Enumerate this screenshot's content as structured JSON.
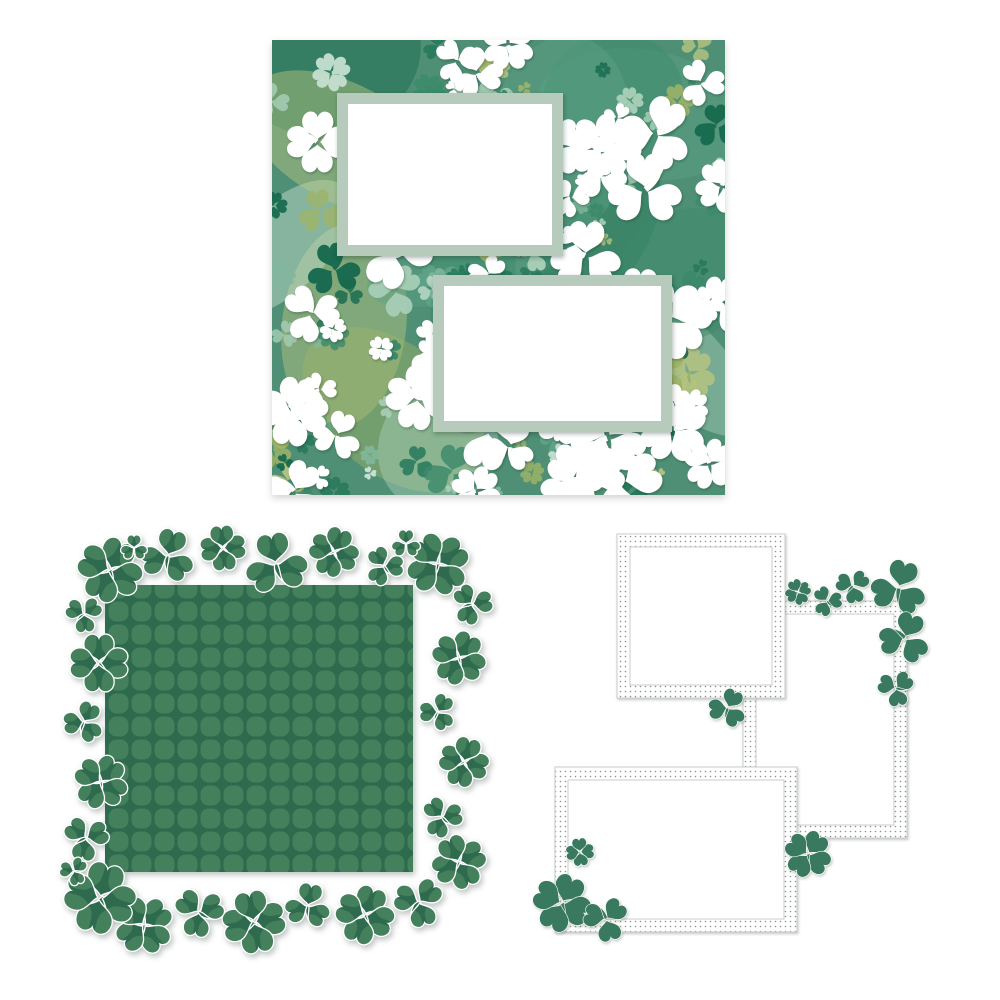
{
  "canvas": {
    "background": "#ffffff",
    "width": 1000,
    "height": 1000,
    "description": "Three St. Patrick's Day shamrock scrapbook die-cut pages on white"
  },
  "clover_page": {
    "x": 272,
    "y": 40,
    "w": 453,
    "h": 455,
    "seed": 1317,
    "base": "#4f8f75",
    "palette": [
      "#176a4e",
      "#27795c",
      "#3b8a6b",
      "#5ea287",
      "#82b89d",
      "#a8cfb8",
      "#c9e2d3",
      "#9fb468",
      "#bcc781"
    ],
    "white": "#ffffff",
    "blotch_count": 14,
    "green_count": 120,
    "white_count": 72,
    "mat_color": "#b6cbbc",
    "mat_inner": "#ffffff",
    "mats": [
      {
        "x": 65,
        "y": 53,
        "w": 226,
        "h": 163,
        "border": 11
      },
      {
        "x": 161,
        "y": 235,
        "w": 239,
        "h": 157,
        "border": 11
      }
    ]
  },
  "diecut_page": {
    "x": 38,
    "y": 508,
    "w": 450,
    "h": 450,
    "base": "#2d6a4e",
    "tile": "#44805b",
    "cut": "#ffffff",
    "square": {
      "x": 67,
      "y": 77,
      "w": 308,
      "h": 287
    },
    "clovers": [
      {
        "x": 72,
        "y": 62,
        "r": 30,
        "t": 4,
        "rot": -20
      },
      {
        "x": 130,
        "y": 48,
        "r": 25,
        "t": 3,
        "rot": 15
      },
      {
        "x": 185,
        "y": 40,
        "r": 21,
        "t": 4,
        "rot": 40
      },
      {
        "x": 238,
        "y": 56,
        "r": 29,
        "t": 3,
        "rot": -10
      },
      {
        "x": 296,
        "y": 44,
        "r": 23,
        "t": 4,
        "rot": 65
      },
      {
        "x": 346,
        "y": 58,
        "r": 18,
        "t": 3,
        "rot": -30
      },
      {
        "x": 400,
        "y": 56,
        "r": 29,
        "t": 4,
        "rot": 10
      },
      {
        "x": 434,
        "y": 96,
        "r": 19,
        "t": 3,
        "rot": 80
      },
      {
        "x": 421,
        "y": 150,
        "r": 25,
        "t": 4,
        "rot": -15
      },
      {
        "x": 400,
        "y": 204,
        "r": 17,
        "t": 3,
        "rot": 30
      },
      {
        "x": 426,
        "y": 254,
        "r": 23,
        "t": 4,
        "rot": 60
      },
      {
        "x": 404,
        "y": 309,
        "r": 19,
        "t": 3,
        "rot": -40
      },
      {
        "x": 421,
        "y": 354,
        "r": 25,
        "t": 4,
        "rot": 20
      },
      {
        "x": 381,
        "y": 394,
        "r": 23,
        "t": 3,
        "rot": 45
      },
      {
        "x": 327,
        "y": 407,
        "r": 27,
        "t": 4,
        "rot": -25
      },
      {
        "x": 270,
        "y": 398,
        "r": 21,
        "t": 3,
        "rot": 10
      },
      {
        "x": 216,
        "y": 414,
        "r": 29,
        "t": 4,
        "rot": 35
      },
      {
        "x": 161,
        "y": 404,
        "r": 23,
        "t": 3,
        "rot": -50
      },
      {
        "x": 106,
        "y": 417,
        "r": 27,
        "t": 4,
        "rot": 5
      },
      {
        "x": 62,
        "y": 390,
        "r": 33,
        "t": 4,
        "rot": -30
      },
      {
        "x": 48,
        "y": 330,
        "r": 21,
        "t": 3,
        "rot": 70
      },
      {
        "x": 63,
        "y": 274,
        "r": 25,
        "t": 4,
        "rot": -10
      },
      {
        "x": 46,
        "y": 214,
        "r": 19,
        "t": 3,
        "rot": 25
      },
      {
        "x": 61,
        "y": 155,
        "r": 27,
        "t": 4,
        "rot": -45
      },
      {
        "x": 46,
        "y": 106,
        "r": 17,
        "t": 3,
        "rot": 55
      },
      {
        "x": 96,
        "y": 40,
        "r": 12,
        "t": 3,
        "rot": 0
      },
      {
        "x": 368,
        "y": 36,
        "r": 13,
        "t": 3,
        "rot": 120
      },
      {
        "x": 36,
        "y": 363,
        "r": 13,
        "t": 3,
        "rot": -80
      }
    ]
  },
  "frame_cluster": {
    "x": 528,
    "y": 524,
    "w": 412,
    "h": 430,
    "clover": "#37795f",
    "dot": "#8b948f",
    "line": "#c9cecb",
    "fill": "#ffffff",
    "band": 13,
    "frames": [
      {
        "name": "tall-frame",
        "x": 215,
        "y": 77,
        "w": 164,
        "h": 237
      },
      {
        "name": "square-frame",
        "x": 89,
        "y": 10,
        "w": 168,
        "h": 164
      },
      {
        "name": "landscape-frame",
        "x": 27,
        "y": 243,
        "w": 242,
        "h": 165
      }
    ],
    "clovers": [
      {
        "x": 270,
        "y": 68,
        "r": 12,
        "t": 4,
        "rot": 20
      },
      {
        "x": 299,
        "y": 77,
        "r": 14,
        "t": 3,
        "rot": -35
      },
      {
        "x": 325,
        "y": 62,
        "r": 16,
        "t": 3,
        "rot": 50
      },
      {
        "x": 371,
        "y": 64,
        "r": 26,
        "t": 3,
        "rot": 15
      },
      {
        "x": 377,
        "y": 114,
        "r": 24,
        "t": 3,
        "rot": 140
      },
      {
        "x": 368,
        "y": 164,
        "r": 17,
        "t": 3,
        "rot": -70
      },
      {
        "x": 200,
        "y": 184,
        "r": 18,
        "t": 3,
        "rot": 25
      },
      {
        "x": 280,
        "y": 330,
        "r": 22,
        "t": 4,
        "rot": -10
      },
      {
        "x": 52,
        "y": 328,
        "r": 13,
        "t": 4,
        "rot": 40
      },
      {
        "x": 34,
        "y": 379,
        "r": 27,
        "t": 4,
        "rot": -20
      },
      {
        "x": 78,
        "y": 395,
        "r": 21,
        "t": 3,
        "rot": 165
      }
    ]
  }
}
